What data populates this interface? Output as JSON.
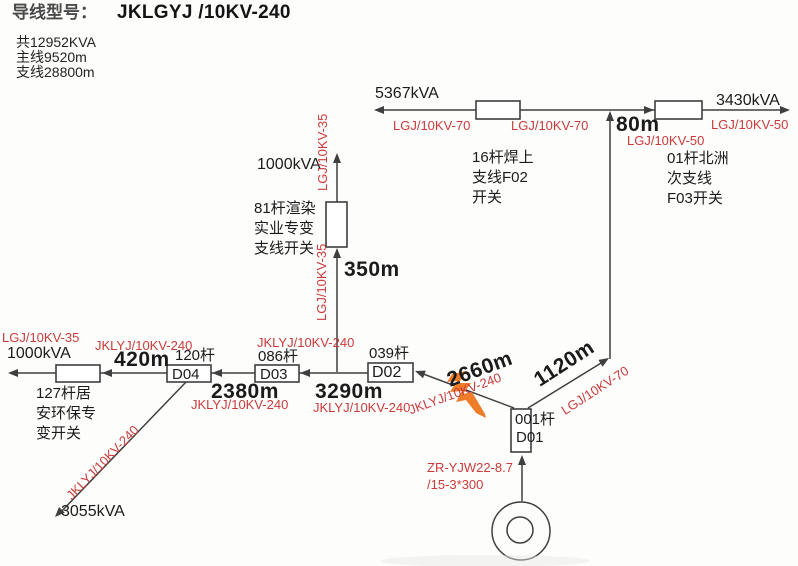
{
  "colors": {
    "red_label": "#cb3a3a",
    "ink": "#1b1b1b",
    "line": "#3f3f3f",
    "highlight_orange": "#ee7d2a"
  },
  "header": {
    "title_label": "导线型号：",
    "title_value": "JKLGYJ /10KV-240",
    "total_capacity": "共12952KVA",
    "main_length": "主线9520m",
    "branch_length": "支线28800m"
  },
  "top_branch": {
    "kva_left": "5367kVA",
    "type_left_outer": "LGJ/10KV-70",
    "type_left_inner": "LGJ/10KV-70",
    "switch_left_label": "16杆焊上\n支线F02\n开关",
    "length": "80m",
    "type_drop": "LGJ/10KV-50",
    "switch_right_label": "01杆北洲\n次支线\nF03开关",
    "type_right": "LGJ/10KV-50",
    "kva_right": "3430kVA"
  },
  "center_branch": {
    "kva": "1000kVA",
    "type_upper": "LGJ/10KV-35",
    "type_lower": "LGJ/10KV-35",
    "switch_label": "81杆渲染\n实业专变\n支线开关",
    "length": "350m"
  },
  "main_line": {
    "end_type": "LGJ/10KV-35",
    "end_kva": "1000kVA",
    "consumer_switch_label": "127杆居\n安环保专\n变开关",
    "seg_d04": {
      "type": "JKLYJ/10KV-240",
      "length": "420m"
    },
    "d04": {
      "pole": "120杆",
      "name": "D04"
    },
    "seg_d03": {
      "length": "2380m",
      "type": "JKLYJ/10KV-240"
    },
    "d03": {
      "pole": "086杆",
      "name": "D03"
    },
    "seg_branch_type": "JKLYJ/10KV-240",
    "seg_d02": {
      "length": "3290m",
      "type": "JKLYJ/10KV-240"
    },
    "d02": {
      "pole": "039杆",
      "name": "D02"
    }
  },
  "spur_d04": {
    "type": "JKLYJ/10KV-240",
    "kva": "3055kVA"
  },
  "feeder": {
    "seg_d01_d02": {
      "length": "2660m",
      "type": "JKLYJ/10KV-240"
    },
    "seg_d01_north": {
      "length": "1120m",
      "type": "LGJ/10KV-70"
    },
    "d01": {
      "pole": "001杆",
      "name": "D01"
    },
    "cable_line1": "ZR-YJW22-8.7",
    "cable_line2": "/15-3*300"
  }
}
